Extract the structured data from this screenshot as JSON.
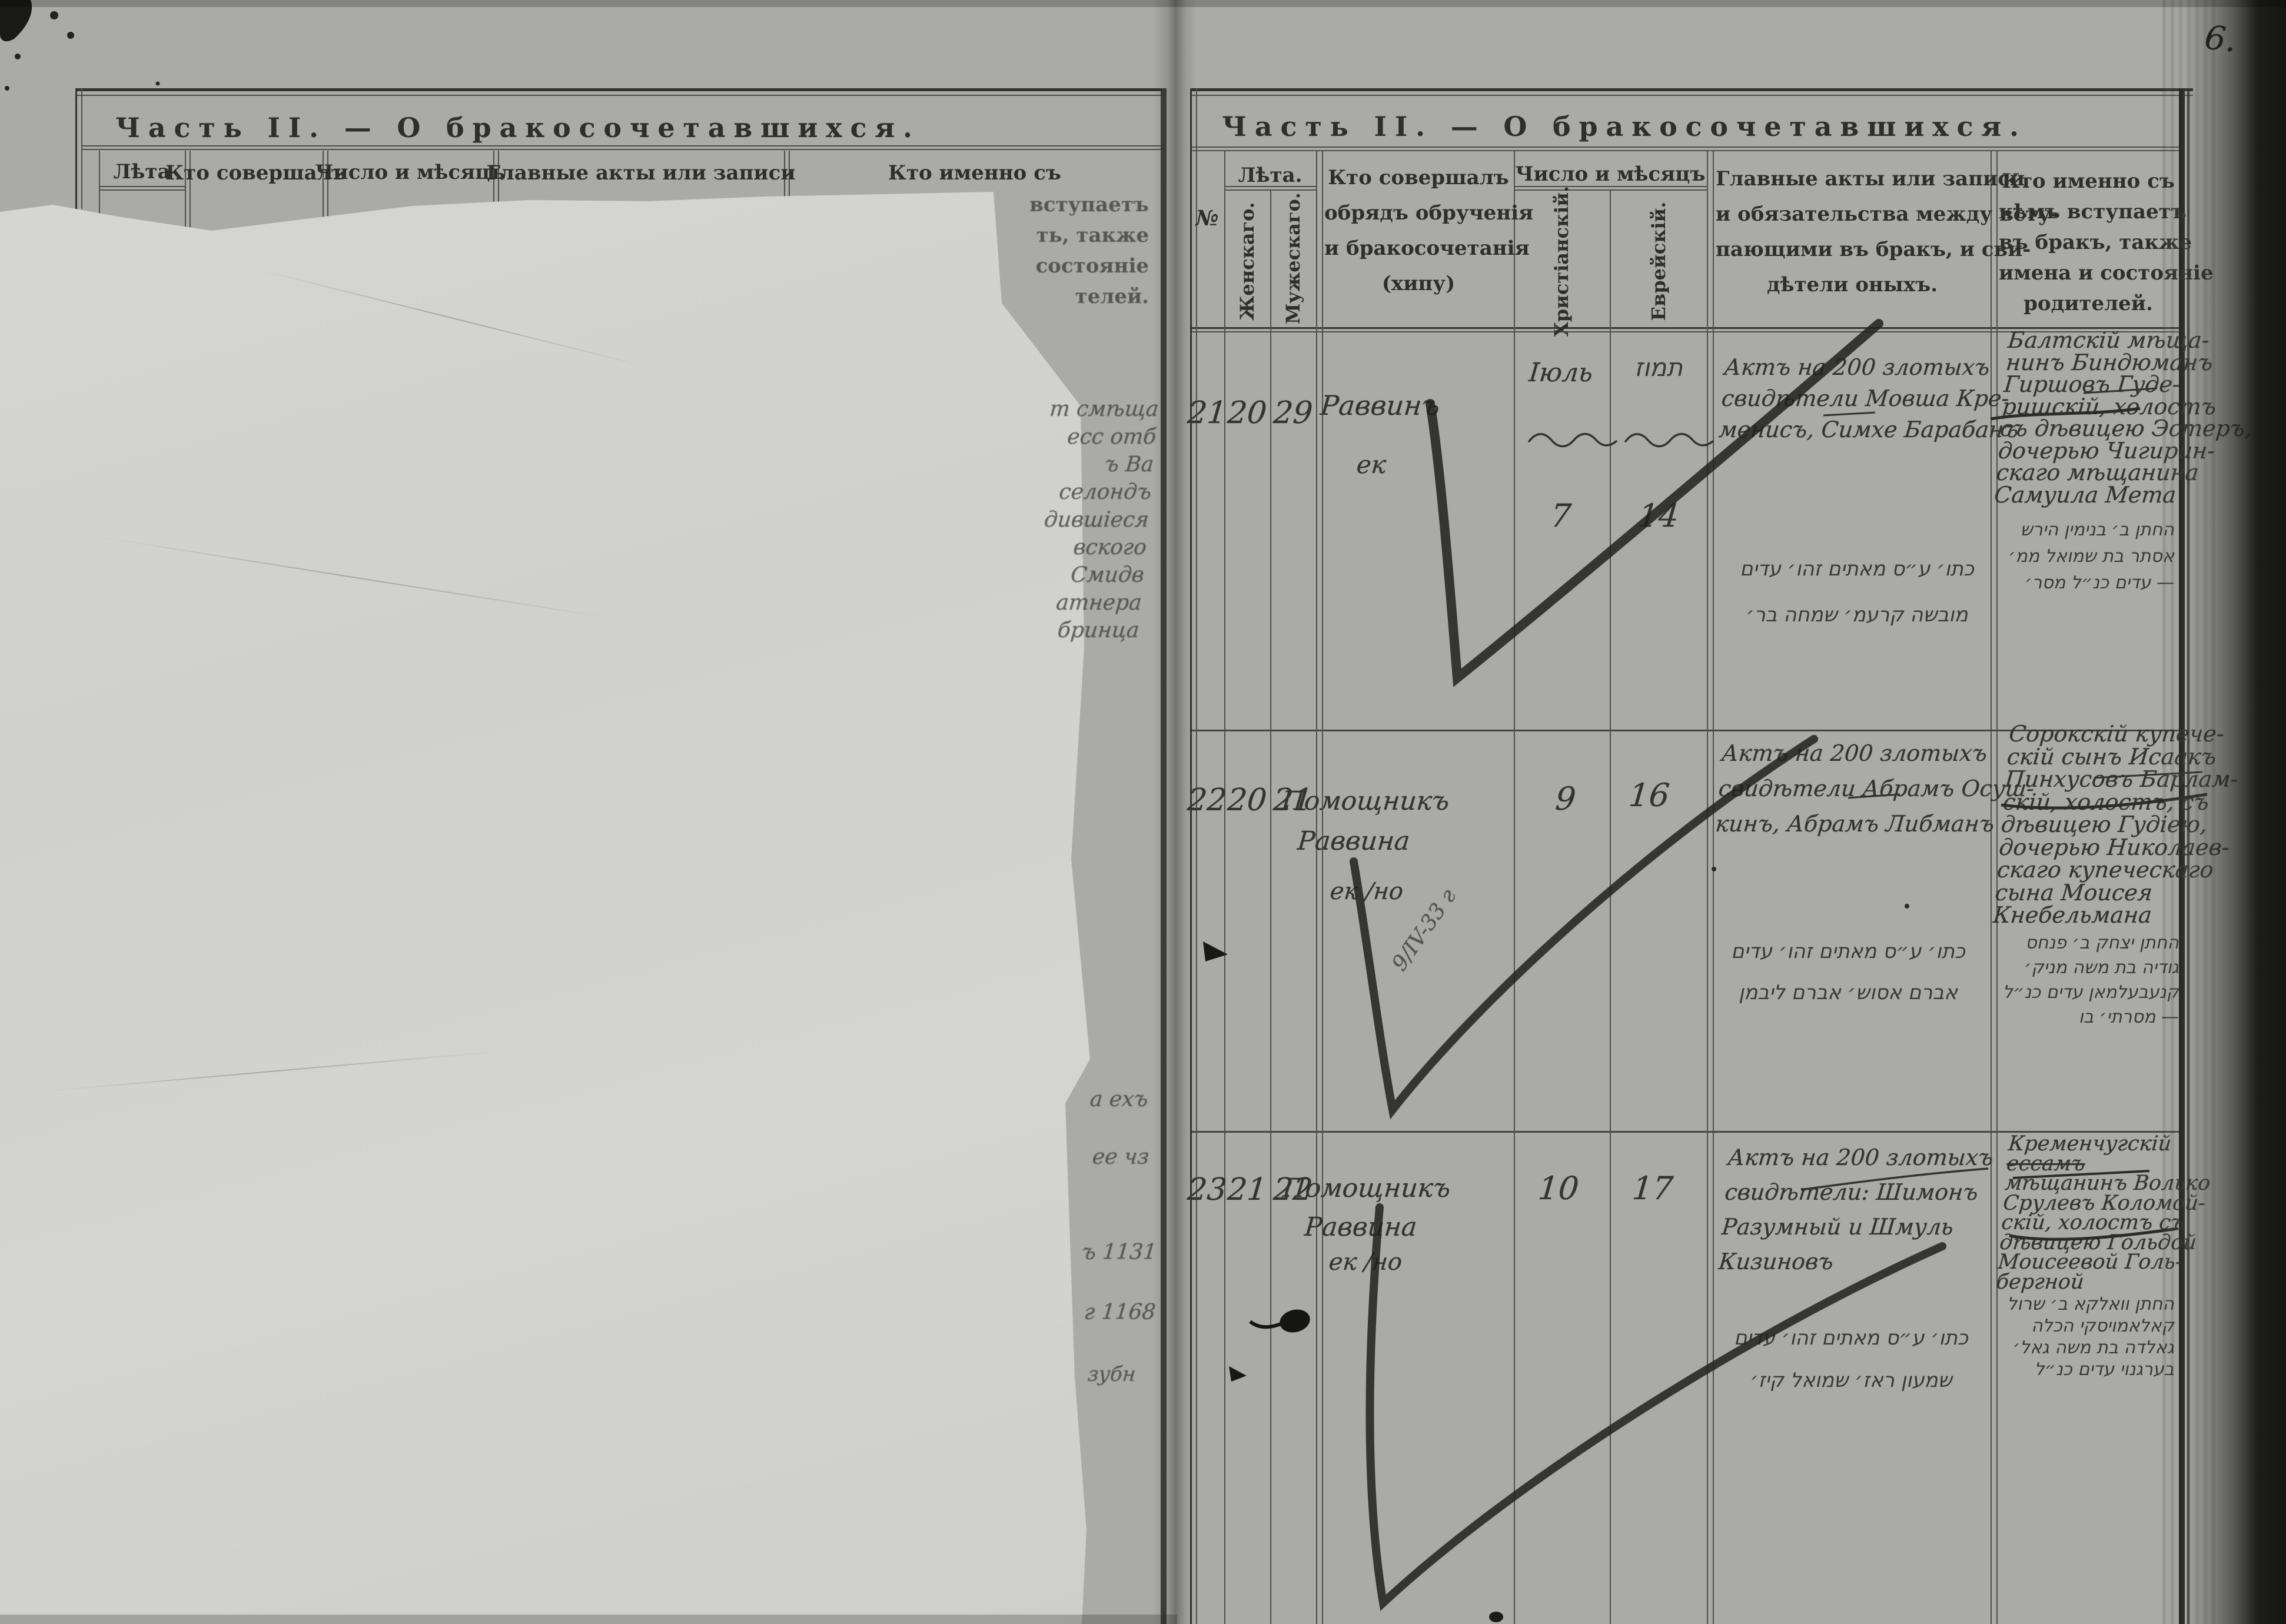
{
  "photo": {
    "page_number": "6."
  },
  "left_page": {
    "title": "Часть II. — О бракосочетавшихся.",
    "headers": {
      "leta": "Лѣта",
      "officiant": "Кто совершалъ",
      "date": "Число и мѣсяцъ",
      "acts": "Главные акты или записи",
      "who": "Кто именно съ"
    },
    "who_tail": [
      "вступаетъ",
      "ть, также",
      "состояніе",
      "телей."
    ],
    "edge_mid": [
      "т смѣща",
      "есс отб",
      "ъ Ва",
      "селондъ",
      "дившіеся",
      "вского",
      "Смидв",
      "атнера",
      "бринца"
    ],
    "edge_bottom": [
      "а ехъ",
      "ее чз",
      "ъ 1131",
      "г 1168",
      "зубн"
    ]
  },
  "right_page": {
    "title": "Часть II. — О бракосочетавшихся.",
    "headers": {
      "no": "№",
      "leta": "Лѣта.",
      "female": "Женскаго.",
      "male": "Мужескаго.",
      "officiant": [
        "Кто совершалъ",
        "обрядъ обрученія",
        "и бракосочетанія",
        "(хипу)"
      ],
      "date": "Число и мѣсяцъ",
      "christian": "Христіанскій.",
      "jewish": "Еврейскій.",
      "acts": [
        "Главные акты или записи",
        "и обязательства между всту-",
        "пающими въ бракъ, и сви-",
        "дѣтели оныхъ."
      ],
      "who": [
        "Кто именно съ",
        "кѣмъ вступаетъ",
        "въ бракъ, также",
        "имена и состояніе",
        "родителей."
      ]
    },
    "rows": [
      {
        "no": "21",
        "female_age": "20",
        "male_age": "29",
        "officiant": "Раввинъ",
        "officiant_mark": "ек",
        "month_christian": "Іюль",
        "day_christian": "7",
        "month_jewish": "תמוז",
        "day_jewish": "14",
        "acts": [
          "Актъ на 200 злотыхъ",
          "свидѣтели Мовша Кре-",
          "менисъ, Симхе Барабанъ"
        ],
        "acts_hebrew": [
          "כתו׳ ע״ס מאתים זהו׳ עדים",
          "מובשה קרעמ׳ שמחה בר׳"
        ],
        "who": [
          "Балтскій мѣща-",
          "нинъ Биндюманъ",
          "Гиршовъ Гуде-",
          "ришскій, холостъ",
          "съ дѣвицею Эстеръ,",
          "дочерью Чигирин-",
          "скаго мѣщанина",
          "Самуила Мета"
        ],
        "who_hebrew": [
          "החתן ב׳ בנימין הירש",
          "אסתר בת שמואל ממ׳",
          "— עדים כנ״ל מסר׳"
        ]
      },
      {
        "no": "22",
        "female_age": "20",
        "male_age": "21",
        "officiant": "Помощникъ",
        "officiant2": "Раввина",
        "officiant_mark": "ек /но",
        "pencil_note": "9/IV-33 г",
        "day_christian": "9",
        "day_jewish": "16",
        "acts": [
          "Актъ на 200 злотыхъ",
          "свидѣтели Абрамъ Осуш-",
          "кинъ, Абрамъ Либманъ"
        ],
        "acts_hebrew": [
          "כתו׳ ע״ס מאתים זהו׳ עדים",
          "אברם אסוש׳ אברם ליבמן"
        ],
        "who": [
          "Сорокскій купече-",
          "скій сынъ Исаакъ",
          "Пинхусовъ Барлам-",
          "скій, холостъ, съ",
          "дѣвицею Гудіею,",
          "дочерью Николаев-",
          "скаго купеческаго",
          "сына Моисея",
          "Кнебельмана"
        ],
        "who_hebrew": [
          "החתן יצחק ב׳ פנחס",
          "גודיה בת משה מניק׳",
          "קנעבעלמאן עדים כנ״ל",
          "— מסרתי׳ בו"
        ]
      },
      {
        "no": "23",
        "female_age": "21",
        "male_age": "22",
        "officiant": "Помощникъ",
        "officiant2": "Раввина",
        "officiant_mark": "ек /но",
        "day_christian": "10",
        "day_jewish": "17",
        "acts": [
          "Актъ на 200 злотыхъ",
          "свидѣтели: Шимонъ",
          "Разумный и Шмуль",
          "Кизиновъ"
        ],
        "acts_hebrew": [
          "כתו׳ ע״ס מאתים זהו׳ עדים",
          "שמעון ראז׳ שמואל קיז׳"
        ],
        "who": [
          "Кременчугскій",
          "ессамъ",
          "мѣщанинъ Волько",
          "Срулевъ Коломой-",
          "скій, холостъ съ",
          "дѣвицею Гольдой",
          "Моисеевой Голь-",
          "бергной"
        ],
        "who_hebrew": [
          "החתן וואלקא ב׳ שרול",
          "קאלאמויסקי הכלה",
          "גאלדה בת משה גאל׳",
          "בערגנוי עדים כנ״ל"
        ]
      }
    ]
  }
}
